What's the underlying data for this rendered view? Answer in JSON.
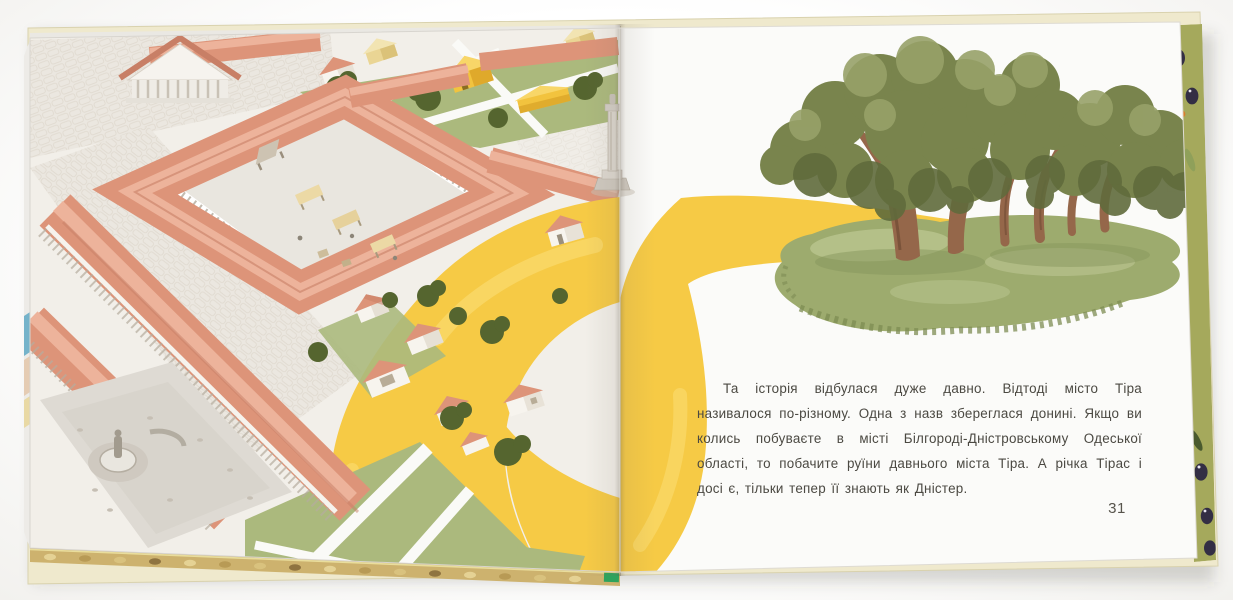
{
  "book": {
    "right_page": {
      "paragraph": "Та історія відбулася дуже давно. Відтоді місто Тіра називалося по-різному. Одна з назв збереглася донині. Якщо ви колись побуваєте в місті Білгороді-Дністровському Одеської області, то побачите руїни давнього міста Тіра. А річка Тірас і досі є, тільки тепер її знають як Дністер.",
      "page_number": "31"
    }
  },
  "palette": {
    "backdrop": "#fdfdfc",
    "page_white": "#fbfbf9",
    "paving": "#f2efe9",
    "roof": "#dd9479",
    "roof_light": "#edb39b",
    "roof_dark": "#c87f66",
    "wall": "#f7f4ee",
    "wall_shadow": "#ddd5c8",
    "lawn": "#abb97d",
    "tree_dark": "#55652f",
    "house_yellow": "#f2c33e",
    "house_yellow_dark": "#d9a227",
    "house_tan": "#ead594",
    "house_tan_dark": "#d4b96e",
    "road": "#f6ca45",
    "road_light": "#fbdc72",
    "grass": "#9dab6e",
    "grass_light": "#bcc792",
    "grass_dark": "#7d8c53",
    "canopy": "#79844d",
    "canopy_light": "#97a169",
    "canopy_dark": "#606b3c",
    "trunk": "#95674a",
    "trunk_dark": "#6f4b33",
    "cover_cream": "#efe9cd",
    "olive_strip": "#a5a95c",
    "olive_berry": "#332e44",
    "olive_leaf": "#4a5a2e",
    "stone": "#d9d4cc",
    "text": "#4b4942"
  }
}
